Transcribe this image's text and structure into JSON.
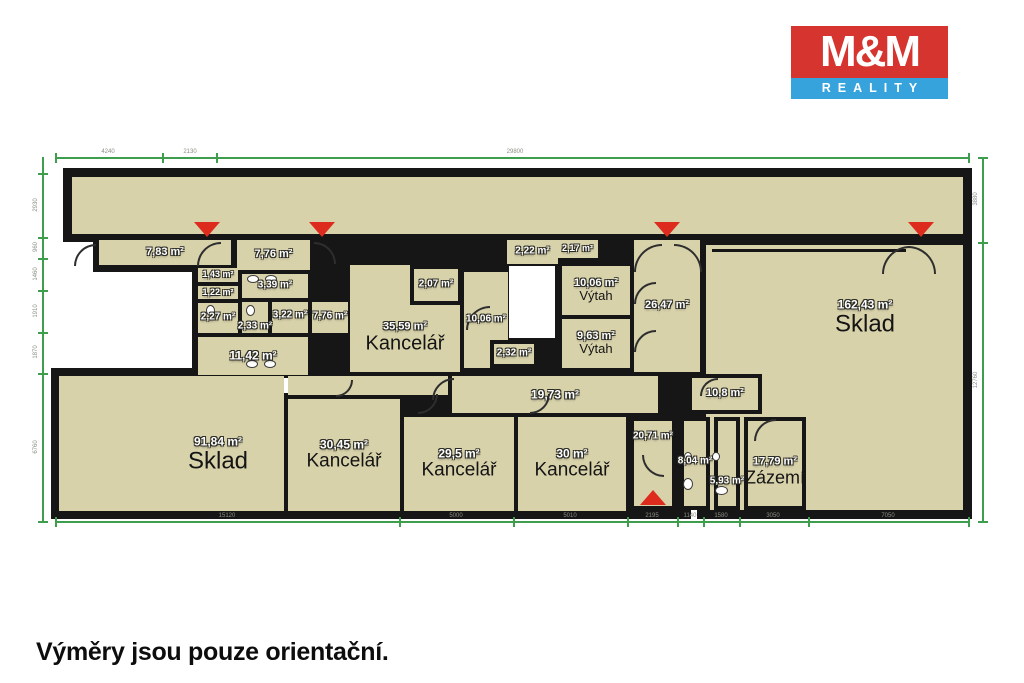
{
  "logo": {
    "line1": "M&M",
    "line2": "REALITY",
    "red": "#d5352e",
    "blue": "#36a3dc"
  },
  "footer": {
    "note": "Výměry jsou pouze orientační."
  },
  "palette": {
    "room_fill": "#d8d2ab",
    "wall": "#161616",
    "dim_green": "#3f9e4e",
    "marker_red": "#dd2c1e",
    "dim_text": "#8d8d85",
    "background": "#ffffff"
  },
  "floorplan": {
    "bases": [
      {
        "id": "base-top-corridor",
        "x": 63,
        "y": 168,
        "w": 909,
        "h": 74
      },
      {
        "id": "base-left-strip",
        "x": 93,
        "y": 234,
        "w": 221,
        "h": 38
      },
      {
        "id": "base-left-block",
        "x": 192,
        "y": 234,
        "w": 160,
        "h": 145
      },
      {
        "id": "base-middle-block",
        "x": 344,
        "y": 234,
        "w": 361,
        "h": 187
      },
      {
        "id": "base-right-block",
        "x": 697,
        "y": 236,
        "w": 275,
        "h": 283
      },
      {
        "id": "base-bottom-block",
        "x": 51,
        "y": 368,
        "w": 640,
        "h": 151
      }
    ],
    "voids": [
      {
        "id": "void-left-notch",
        "x": 97,
        "y": 272,
        "w": 95,
        "h": 96
      },
      {
        "id": "void-staircase",
        "x": 509,
        "y": 266,
        "w": 46,
        "h": 72
      },
      {
        "id": "void-door-square",
        "x": 283,
        "y": 378,
        "w": 12,
        "h": 15
      }
    ],
    "walls": [
      {
        "id": "wall-sklad-beam",
        "x": 712,
        "y": 249,
        "w": 194,
        "h": 3
      }
    ],
    "rooms": [
      {
        "id": "room-top-corridor",
        "x": 72,
        "y": 177,
        "w": 891,
        "h": 57
      },
      {
        "id": "room-783",
        "x": 99,
        "y": 240,
        "w": 132,
        "h": 25,
        "area": "7,83 m²",
        "fs": 11
      },
      {
        "id": "room-776-a",
        "x": 237,
        "y": 240,
        "w": 73,
        "h": 30,
        "area": "7,76 m²",
        "fs": 11
      },
      {
        "id": "room-143",
        "x": 198,
        "y": 268,
        "w": 40,
        "h": 14,
        "area": "1,43 m²",
        "fs": 9
      },
      {
        "id": "room-122",
        "x": 198,
        "y": 286,
        "w": 40,
        "h": 13,
        "area": "1,22 m²",
        "fs": 9
      },
      {
        "id": "room-339",
        "x": 242,
        "y": 274,
        "w": 66,
        "h": 24,
        "area": "3,39 m²",
        "fs": 10
      },
      {
        "id": "room-227",
        "x": 198,
        "y": 303,
        "w": 40,
        "h": 30,
        "area": "2,27 m²",
        "fs": 10
      },
      {
        "id": "room-233",
        "x": 242,
        "y": 302,
        "w": 26,
        "h": 31,
        "area": "2,33 m²",
        "fs": 10,
        "ly": 327
      },
      {
        "id": "room-322",
        "x": 272,
        "y": 302,
        "w": 36,
        "h": 31,
        "area": "3,22 m²",
        "fs": 10,
        "ly": 316
      },
      {
        "id": "room-776-b",
        "x": 312,
        "y": 302,
        "w": 36,
        "h": 31,
        "area": "7,76 m²",
        "fs": 10,
        "ly": 317
      },
      {
        "id": "room-1142",
        "x": 198,
        "y": 337,
        "w": 110,
        "h": 38,
        "area": "11,42 m²",
        "fs": 12
      },
      {
        "id": "room-kancelar-3559",
        "x": 350,
        "y": 265,
        "w": 110,
        "h": 107,
        "area": "35,59 m²",
        "fs": 11,
        "name": "Kancelář",
        "nfs": 20,
        "lx": 405,
        "ly": 338
      },
      {
        "id": "room-207",
        "x": 410,
        "y": 265,
        "w": 52,
        "h": 40,
        "b": 4,
        "area": "2,07 m²",
        "fs": 10
      },
      {
        "id": "room-1006-chodba",
        "x": 464,
        "y": 272,
        "w": 44,
        "h": 96,
        "area": "10,06 m²",
        "fs": 10,
        "ly": 320
      },
      {
        "id": "room-232",
        "x": 490,
        "y": 340,
        "w": 48,
        "h": 28,
        "b": 4,
        "area": "2,32 m²",
        "fs": 10
      },
      {
        "id": "room-222",
        "x": 507,
        "y": 240,
        "w": 51,
        "h": 24,
        "area": "2,22 m²",
        "fs": 10
      },
      {
        "id": "room-217",
        "x": 557,
        "y": 240,
        "w": 41,
        "h": 18,
        "area": "2,17 m²",
        "fs": 9
      },
      {
        "id": "room-vytah-1006",
        "x": 562,
        "y": 266,
        "w": 68,
        "h": 49,
        "area": "10,06 m²",
        "fs": 11,
        "name": "Výtah",
        "nfs": 13
      },
      {
        "id": "room-vytah-963",
        "x": 562,
        "y": 319,
        "w": 68,
        "h": 49,
        "area": "9,63 m²",
        "fs": 11,
        "name": "Výtah",
        "nfs": 13
      },
      {
        "id": "room-corridor-small",
        "x": 288,
        "y": 376,
        "w": 160,
        "h": 19
      },
      {
        "id": "room-corridor-1973",
        "x": 452,
        "y": 376,
        "w": 206,
        "h": 37,
        "area": "19,73 m²",
        "fs": 12
      },
      {
        "id": "room-2647",
        "x": 634,
        "y": 240,
        "w": 66,
        "h": 132,
        "area": "26,47 m²",
        "fs": 11
      },
      {
        "id": "room-sklad-16243",
        "x": 706,
        "y": 245,
        "w": 257,
        "h": 265,
        "area": "162,43 m²",
        "fs": 12,
        "name": "Sklad",
        "nfs": 24,
        "lx": 865,
        "ly": 318
      },
      {
        "id": "room-108",
        "x": 688,
        "y": 374,
        "w": 74,
        "h": 40,
        "b": 4,
        "area": "10,8 m²",
        "fs": 11
      },
      {
        "id": "room-2071",
        "x": 630,
        "y": 417,
        "w": 46,
        "h": 93,
        "b": 4,
        "area": "20,71 m²",
        "fs": 10,
        "ly": 437
      },
      {
        "id": "room-804",
        "x": 680,
        "y": 417,
        "w": 30,
        "h": 93,
        "b": 4,
        "area": "8,04 m²",
        "fs": 10,
        "ly": 462
      },
      {
        "id": "room-593",
        "x": 714,
        "y": 417,
        "w": 26,
        "h": 93,
        "b": 4,
        "area": "5,93 m²",
        "fs": 10,
        "ly": 482
      },
      {
        "id": "room-zazemi-1779",
        "x": 744,
        "y": 417,
        "w": 62,
        "h": 93,
        "b": 4,
        "area": "17,79 m²",
        "fs": 11,
        "name": "Zázemí",
        "nfs": 18,
        "ly": 472
      },
      {
        "id": "room-sklad-9184",
        "x": 59,
        "y": 376,
        "w": 225,
        "h": 135,
        "area": "91,84 m²",
        "fs": 12,
        "name": "Sklad",
        "nfs": 24,
        "lx": 218,
        "ly": 455
      },
      {
        "id": "room-kancelar-3045",
        "x": 288,
        "y": 399,
        "w": 112,
        "h": 112,
        "area": "30,45 m²",
        "fs": 12,
        "name": "Kancelář",
        "nfs": 19
      },
      {
        "id": "room-kancelar-295",
        "x": 404,
        "y": 417,
        "w": 110,
        "h": 94,
        "area": "29,5 m²",
        "fs": 12,
        "name": "Kancelář",
        "nfs": 19
      },
      {
        "id": "room-kancelar-30",
        "x": 518,
        "y": 417,
        "w": 108,
        "h": 94,
        "area": "30 m²",
        "fs": 12,
        "name": "Kancelář",
        "nfs": 19
      }
    ],
    "doors": [
      {
        "x": 74,
        "y": 244,
        "r": 20,
        "rot": 0
      },
      {
        "x": 197,
        "y": 242,
        "r": 22,
        "rot": 0
      },
      {
        "x": 314,
        "y": 242,
        "r": 20,
        "rot": 90
      },
      {
        "x": 634,
        "y": 244,
        "r": 26,
        "rot": 0
      },
      {
        "x": 674,
        "y": 244,
        "r": 26,
        "rot": 90
      },
      {
        "x": 882,
        "y": 246,
        "r": 26,
        "rot": 0
      },
      {
        "x": 908,
        "y": 246,
        "r": 26,
        "rot": 90
      },
      {
        "x": 634,
        "y": 282,
        "r": 20,
        "rot": 0
      },
      {
        "x": 634,
        "y": 330,
        "r": 20,
        "rot": 0
      },
      {
        "x": 466,
        "y": 306,
        "r": 22,
        "rot": 0
      },
      {
        "x": 432,
        "y": 378,
        "r": 20,
        "rot": 0
      },
      {
        "x": 418,
        "y": 394,
        "r": 18,
        "rot": 180
      },
      {
        "x": 530,
        "y": 394,
        "r": 18,
        "rot": 180
      },
      {
        "x": 336,
        "y": 380,
        "r": 15,
        "rot": 180
      },
      {
        "x": 700,
        "y": 378,
        "r": 16,
        "rot": 0
      },
      {
        "x": 754,
        "y": 419,
        "r": 20,
        "rot": 0
      },
      {
        "x": 642,
        "y": 455,
        "r": 20,
        "rot": 270
      }
    ],
    "fixtures": [
      {
        "x": 247,
        "y": 275,
        "w": 12,
        "h": 8
      },
      {
        "x": 265,
        "y": 275,
        "w": 12,
        "h": 8
      },
      {
        "x": 206,
        "y": 305,
        "w": 9,
        "h": 11
      },
      {
        "x": 246,
        "y": 305,
        "w": 9,
        "h": 11
      },
      {
        "x": 246,
        "y": 360,
        "w": 12,
        "h": 8
      },
      {
        "x": 264,
        "y": 360,
        "w": 12,
        "h": 8
      },
      {
        "x": 684,
        "y": 452,
        "w": 8,
        "h": 9
      },
      {
        "x": 712,
        "y": 452,
        "w": 8,
        "h": 9
      },
      {
        "x": 683,
        "y": 478,
        "w": 10,
        "h": 12
      },
      {
        "x": 715,
        "y": 486,
        "w": 13,
        "h": 9
      }
    ],
    "markers": [
      {
        "id": "marker-entrance-1",
        "dir": "down",
        "x": 194,
        "y": 222
      },
      {
        "id": "marker-entrance-2",
        "dir": "down",
        "x": 309,
        "y": 222
      },
      {
        "id": "marker-entrance-3",
        "dir": "down",
        "x": 654,
        "y": 222
      },
      {
        "id": "marker-entrance-4",
        "dir": "down",
        "x": 908,
        "y": 222
      },
      {
        "id": "marker-entrance-5",
        "dir": "up",
        "x": 640,
        "y": 490
      }
    ],
    "dims": [
      {
        "id": "dim-top",
        "o": "h",
        "x1": 55,
        "x2": 968,
        "y": 157,
        "ticks": [
          55,
          162,
          216,
          968
        ],
        "labels": [
          {
            "t": "4240",
            "p": 108
          },
          {
            "t": "2130",
            "p": 190
          },
          {
            "t": "29800",
            "p": 515
          }
        ]
      },
      {
        "id": "dim-bottom",
        "o": "h",
        "x1": 55,
        "x2": 968,
        "y": 521,
        "ticks": [
          55,
          399,
          513,
          627,
          677,
          703,
          739,
          808,
          968
        ],
        "labels": [
          {
            "t": "15120",
            "p": 227
          },
          {
            "t": "5000",
            "p": 456
          },
          {
            "t": "5010",
            "p": 570
          },
          {
            "t": "2195",
            "p": 652
          },
          {
            "t": "1140",
            "p": 690
          },
          {
            "t": "1580",
            "p": 721
          },
          {
            "t": "3050",
            "p": 773
          },
          {
            "t": "7050",
            "p": 888
          }
        ]
      },
      {
        "id": "dim-left",
        "o": "v",
        "x": 42,
        "y1": 157,
        "y2": 521,
        "ticks": [
          173,
          237,
          258,
          290,
          332,
          373,
          521
        ],
        "labels": [
          {
            "t": "2930",
            "p": 205
          },
          {
            "t": "960",
            "p": 247
          },
          {
            "t": "1460",
            "p": 274
          },
          {
            "t": "1910",
            "p": 311
          },
          {
            "t": "1870",
            "p": 352
          },
          {
            "t": "6760",
            "p": 447
          }
        ]
      },
      {
        "id": "dim-right",
        "o": "v",
        "x": 982,
        "y1": 157,
        "y2": 521,
        "ticks": [
          157,
          242,
          521
        ],
        "labels": [
          {
            "t": "3880",
            "p": 199
          },
          {
            "t": "12760",
            "p": 380
          }
        ]
      }
    ]
  }
}
